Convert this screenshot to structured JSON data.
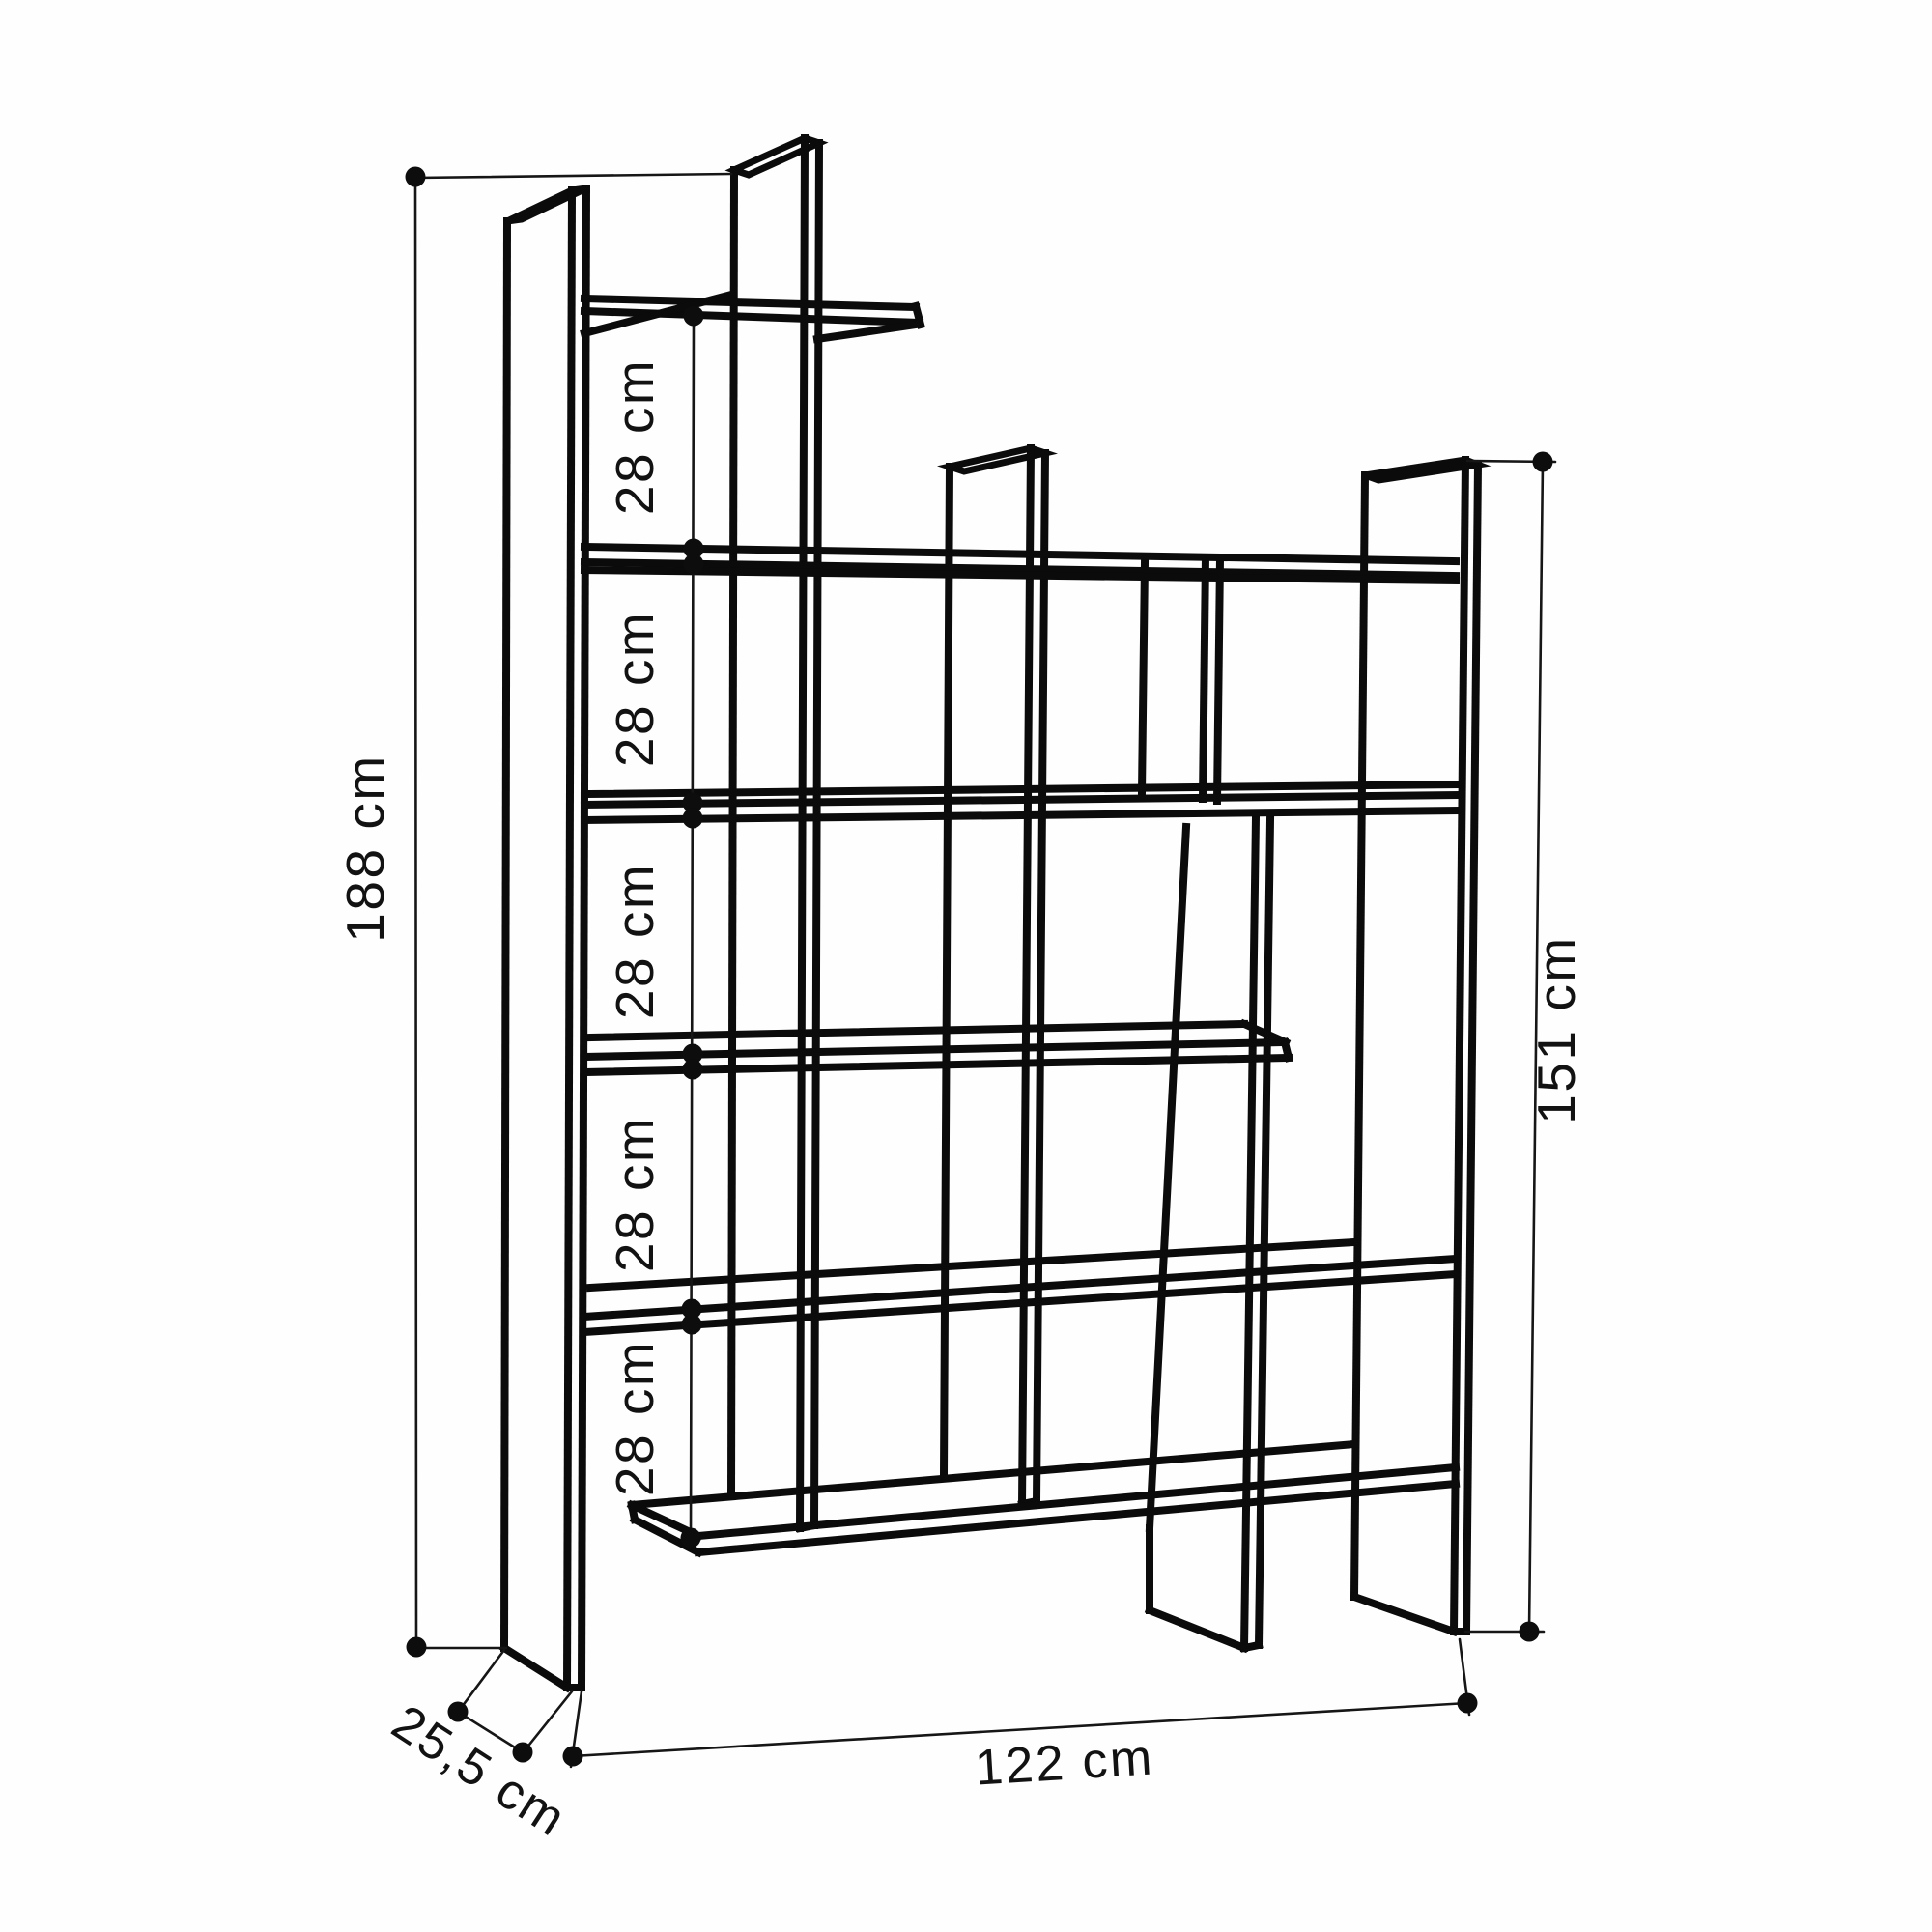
{
  "diagram": {
    "type": "furniture-dimension-drawing",
    "subject": "staggered cube bookshelf, isometric wireframe line drawing",
    "background_color": "#fefefe",
    "line_color": "#0b0b0b",
    "units": "cm",
    "dimensions": {
      "total_height": {
        "label": "188 cm",
        "value_cm": 188,
        "orientation": "vertical",
        "position": "outer-left"
      },
      "shelf_spacings": {
        "labels": [
          "28 cm",
          "28 cm",
          "28 cm",
          "28 cm",
          "28 cm"
        ],
        "value_cm": 28,
        "orientation": "vertical",
        "position": "inner-left-column"
      },
      "right_side_height": {
        "label": "151 cm",
        "value_cm": 151,
        "orientation": "vertical",
        "position": "outer-right"
      },
      "total_width": {
        "label": "122 cm",
        "value_cm": 122,
        "orientation": "horizontal",
        "position": "bottom"
      },
      "depth": {
        "label": "25,5 cm",
        "value_cm": 25.5,
        "orientation": "diagonal",
        "position": "bottom-left"
      }
    }
  }
}
